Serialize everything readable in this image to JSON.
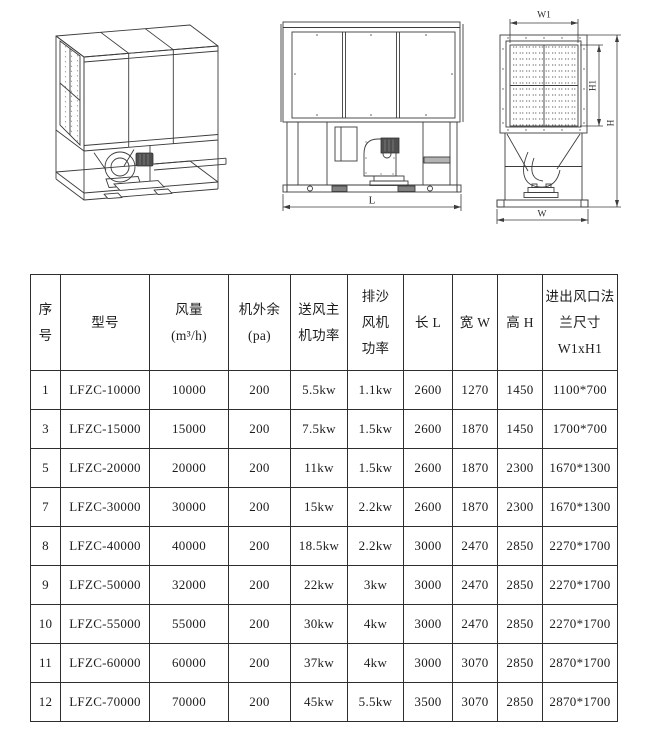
{
  "drawings": {
    "iso_view": {
      "description": "isometric view of sand-proof air cooling unit"
    },
    "front_view": {
      "dim_length": "L"
    },
    "side_view": {
      "dim_top_width": "W1",
      "dim_panel_height": "H1",
      "dim_total_height": "H",
      "dim_total_width": "W"
    }
  },
  "table": {
    "headers": {
      "index": [
        "序",
        "号"
      ],
      "model": [
        "型号"
      ],
      "airflow": [
        "风量",
        "(m³/h)"
      ],
      "static_pressure": [
        "机外余",
        "(pa)"
      ],
      "supply_fan_power": [
        "送风主",
        "机功率"
      ],
      "sand_fan_power": [
        "排沙",
        "风机",
        "功率"
      ],
      "length": [
        "长 L"
      ],
      "width": [
        "宽 W"
      ],
      "height": [
        "高 H"
      ],
      "flange_size": [
        "进出风口法",
        "兰尺寸",
        "W1xH1"
      ]
    },
    "rows": [
      [
        "1",
        "LFZC-10000",
        "10000",
        "200",
        "5.5kw",
        "1.1kw",
        "2600",
        "1270",
        "1450",
        "1100*700"
      ],
      [
        "3",
        "LFZC-15000",
        "15000",
        "200",
        "7.5kw",
        "1.5kw",
        "2600",
        "1870",
        "1450",
        "1700*700"
      ],
      [
        "5",
        "LFZC-20000",
        "20000",
        "200",
        "11kw",
        "1.5kw",
        "2600",
        "1870",
        "2300",
        "1670*1300"
      ],
      [
        "7",
        "LFZC-30000",
        "30000",
        "200",
        "15kw",
        "2.2kw",
        "2600",
        "1870",
        "2300",
        "1670*1300"
      ],
      [
        "8",
        "LFZC-40000",
        "40000",
        "200",
        "18.5kw",
        "2.2kw",
        "3000",
        "2470",
        "2850",
        "2270*1700"
      ],
      [
        "9",
        "LFZC-50000",
        "32000",
        "200",
        "22kw",
        "3kw",
        "3000",
        "2470",
        "2850",
        "2270*1700"
      ],
      [
        "10",
        "LFZC-55000",
        "55000",
        "200",
        "30kw",
        "4kw",
        "3000",
        "2470",
        "2850",
        "2270*1700"
      ],
      [
        "11",
        "LFZC-60000",
        "60000",
        "200",
        "37kw",
        "4kw",
        "3000",
        "3070",
        "2850",
        "2870*1700"
      ],
      [
        "12",
        "LFZC-70000",
        "70000",
        "200",
        "45kw",
        "5.5kw",
        "3500",
        "3070",
        "2850",
        "2870*1700"
      ]
    ]
  }
}
